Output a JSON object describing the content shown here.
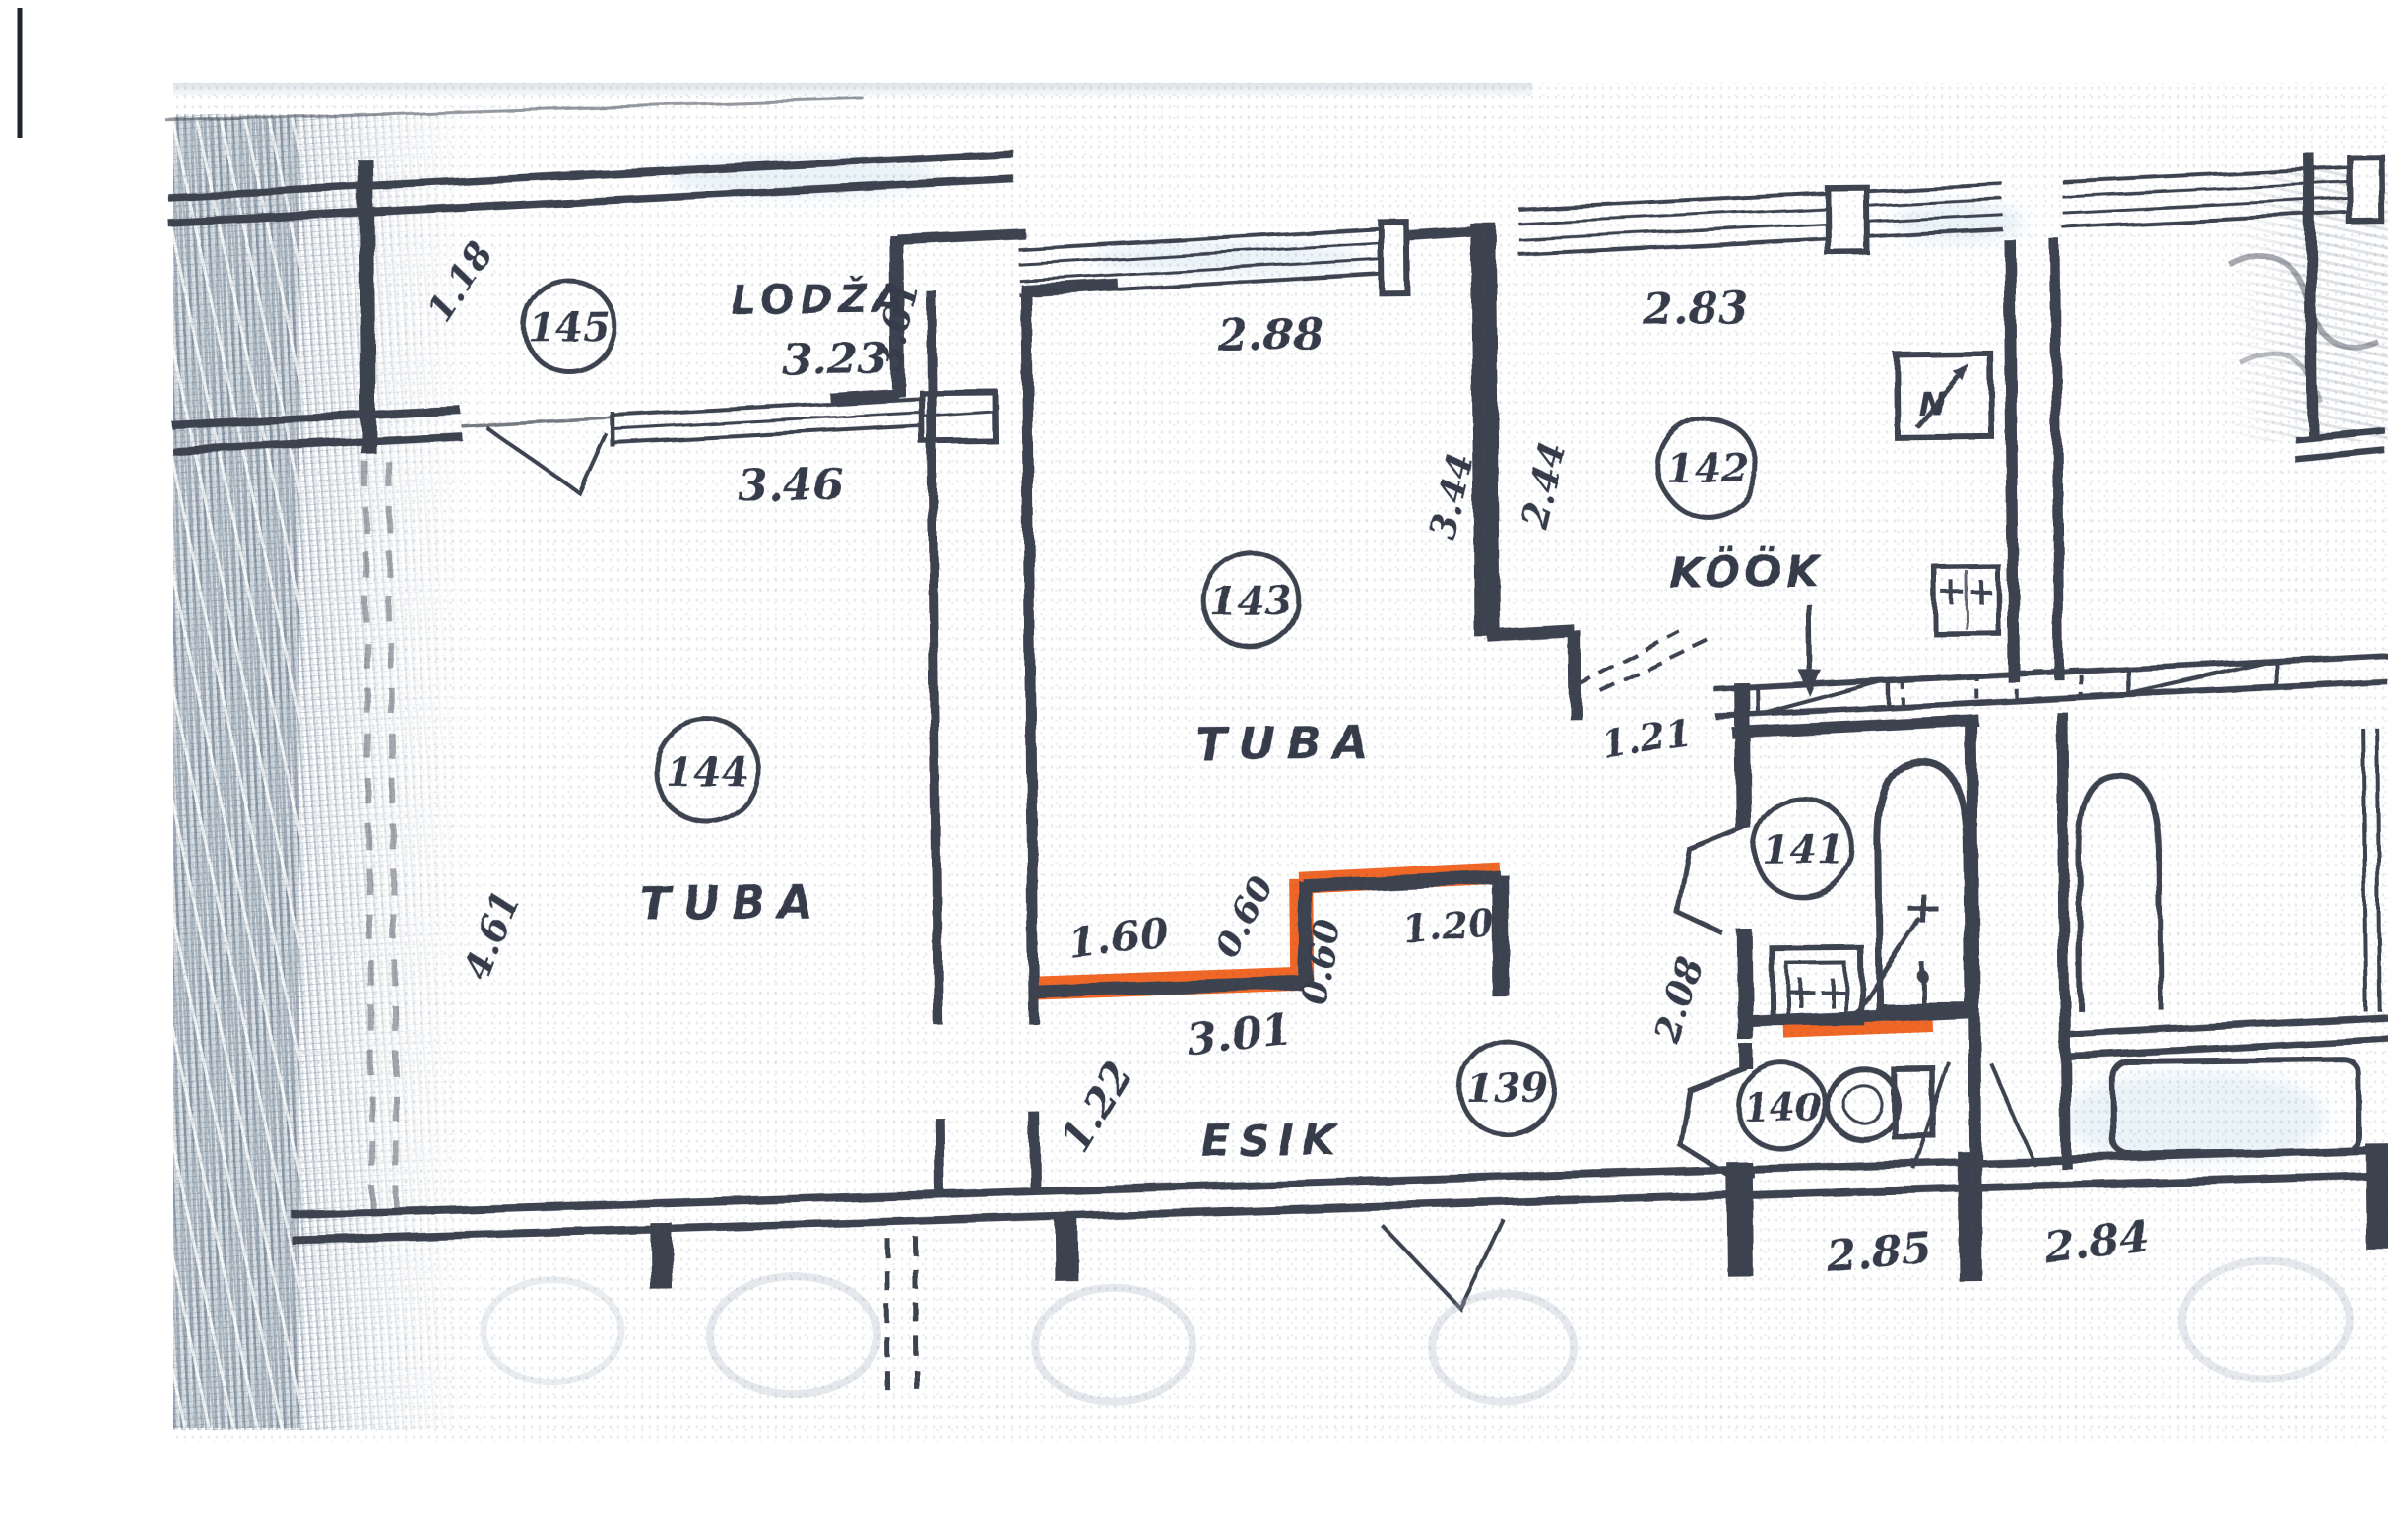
{
  "rooms": {
    "lodza": {
      "number": "145",
      "name": "LODŽA"
    },
    "tuba_left": {
      "number": "144",
      "name": "TUBA"
    },
    "tuba_mid": {
      "number": "143",
      "name": "TUBA"
    },
    "kook": {
      "number": "142",
      "name": "KÖÖK"
    },
    "bathroom": {
      "number": "141"
    },
    "wc": {
      "number": "140"
    },
    "esik": {
      "number": "139",
      "name": "ESIK"
    }
  },
  "dims": {
    "lodza_depth": "1.18",
    "lodza_width": "3.23",
    "lodza_window_width": "3.46",
    "tuba_mid_width": "2.88",
    "tuba_mid_depth": "3.61",
    "center_wall_left": "3.44",
    "center_wall_right": "2.44",
    "kook_width": "2.83",
    "kook_door": "1.21",
    "tuba_left_depth": "4.61",
    "esik_wall_a": "1.60",
    "esik_wall_b": "0.60",
    "esik_wall_c": "0.60",
    "esik_wall_d": "1.20",
    "esik_width": "3.01",
    "esik_depth": "1.22",
    "bath_depth": "2.08",
    "bay_left": "2.85",
    "bay_right": "2.84"
  },
  "symbols": {
    "north": "N"
  },
  "colors": {
    "ink": "#3d4250",
    "highlight": "#f05a14",
    "paper": "#ffffff"
  }
}
